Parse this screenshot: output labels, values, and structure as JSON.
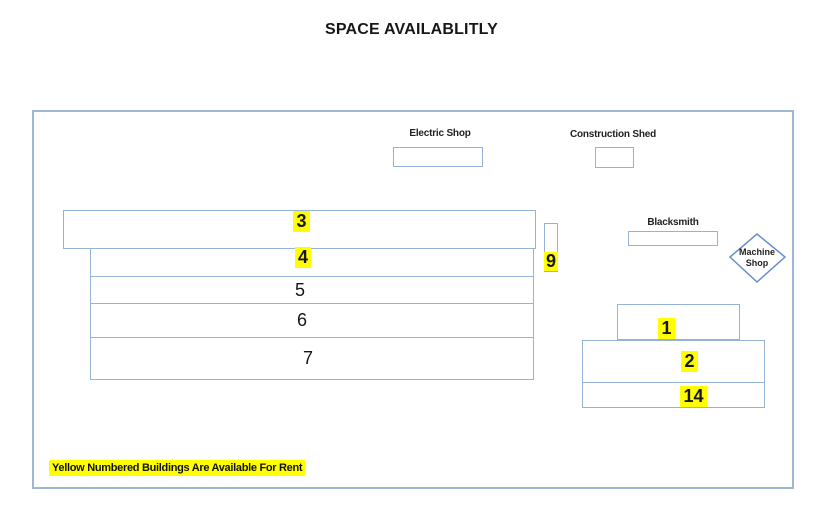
{
  "title": "SPACE AVAILABLITLY",
  "note": "Yellow Numbered Buildings Are Available For Rent",
  "colors": {
    "building_border": "#95b3d7",
    "site_border": "#9fb6d6",
    "diamond_border": "#6690c8",
    "highlight": "#ffff00",
    "text": "#1a1a1a"
  },
  "shops": {
    "electric": {
      "label": "Electric Shop"
    },
    "construction": {
      "label": "Construction Shed"
    },
    "blacksmith": {
      "label": "Blacksmith"
    },
    "machine": {
      "line1": "Machine",
      "line2": "Shop"
    }
  },
  "buildings": {
    "b3": {
      "number": "3",
      "available": true
    },
    "b4": {
      "number": "4",
      "available": true
    },
    "b5": {
      "number": "5",
      "available": false
    },
    "b6": {
      "number": "6",
      "available": false
    },
    "b7": {
      "number": "7",
      "available": false
    },
    "b9": {
      "number": "9",
      "available": true
    },
    "b1": {
      "number": "1",
      "available": true
    },
    "b2": {
      "number": "2",
      "available": true
    },
    "b14": {
      "number": "14",
      "available": true
    }
  }
}
